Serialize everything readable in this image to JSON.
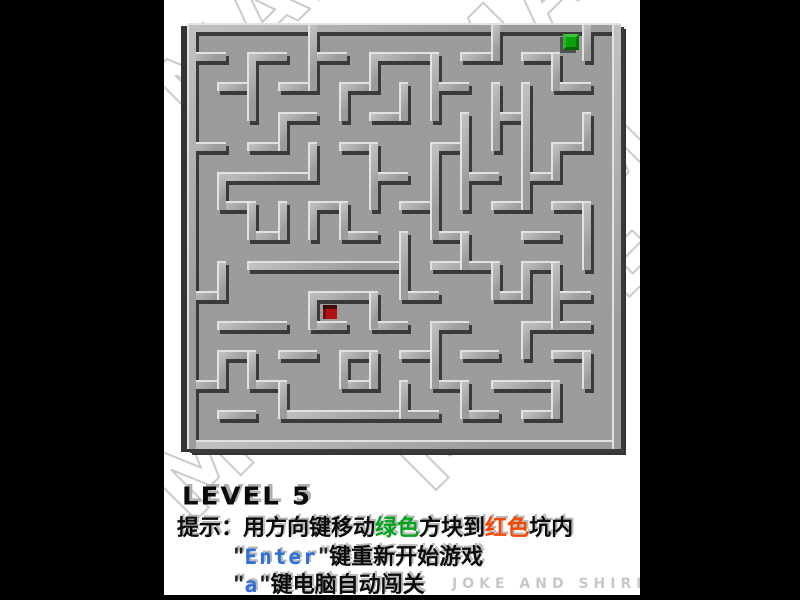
{
  "window": {
    "background": "#000000",
    "canvas_background": "#ffffff",
    "canvas_left": 164,
    "canvas_width": 476,
    "canvas_height": 595
  },
  "watermark": {
    "text": "MAZE",
    "stroke_color": "#cbcbcb",
    "instances": [
      {
        "left": -40,
        "top": -60,
        "size": 90
      },
      {
        "left": 240,
        "top": -80,
        "size": 90
      },
      {
        "left": -50,
        "top": 320,
        "size": 100
      },
      {
        "left": 190,
        "top": 290,
        "size": 100
      },
      {
        "left": 370,
        "top": 30,
        "size": 90
      }
    ]
  },
  "maze": {
    "grid": {
      "cols": 14,
      "rows": 14,
      "cellW": 30.4,
      "cellH": 29.8,
      "originX": 27,
      "originY": 27,
      "thickness": 9,
      "shadowDX": 3,
      "shadowDY": 4
    },
    "colors": {
      "floor": "#9c9c9c",
      "wall_face": "#a6a6a6",
      "wall_light": "#e2e2e2",
      "wall_shadow": "#3a3a3a"
    },
    "h_walls": [
      [
        0,
        0,
        14
      ],
      [
        14,
        0,
        14
      ],
      [
        1,
        0,
        1
      ],
      [
        1,
        2,
        3
      ],
      [
        1,
        4,
        5
      ],
      [
        1,
        6,
        8
      ],
      [
        1,
        9,
        10
      ],
      [
        1,
        11,
        12
      ],
      [
        2,
        1,
        2
      ],
      [
        2,
        3,
        4
      ],
      [
        2,
        5,
        6
      ],
      [
        2,
        8,
        9
      ],
      [
        2,
        12,
        13
      ],
      [
        3,
        3,
        4
      ],
      [
        3,
        6,
        7
      ],
      [
        3,
        10,
        11
      ],
      [
        4,
        0,
        1
      ],
      [
        4,
        2,
        3
      ],
      [
        4,
        5,
        6
      ],
      [
        4,
        8,
        9
      ],
      [
        4,
        12,
        13
      ],
      [
        5,
        1,
        4
      ],
      [
        5,
        6,
        7
      ],
      [
        5,
        9,
        10
      ],
      [
        5,
        11,
        12
      ],
      [
        6,
        1,
        2
      ],
      [
        6,
        4,
        5
      ],
      [
        6,
        7,
        8
      ],
      [
        6,
        10,
        11
      ],
      [
        6,
        12,
        13
      ],
      [
        7,
        2,
        3
      ],
      [
        7,
        5,
        6
      ],
      [
        7,
        8,
        9
      ],
      [
        7,
        11,
        12
      ],
      [
        8,
        2,
        7
      ],
      [
        8,
        8,
        10
      ],
      [
        8,
        11,
        12
      ],
      [
        9,
        0,
        1
      ],
      [
        9,
        4,
        6
      ],
      [
        9,
        7,
        8
      ],
      [
        9,
        10,
        11
      ],
      [
        9,
        12,
        13
      ],
      [
        10,
        1,
        3
      ],
      [
        10,
        4,
        5
      ],
      [
        10,
        6,
        7
      ],
      [
        10,
        8,
        9
      ],
      [
        10,
        11,
        13
      ],
      [
        11,
        1,
        2
      ],
      [
        11,
        3,
        4
      ],
      [
        11,
        5,
        6
      ],
      [
        11,
        7,
        8
      ],
      [
        11,
        9,
        10
      ],
      [
        11,
        12,
        13
      ],
      [
        12,
        0,
        1
      ],
      [
        12,
        2,
        3
      ],
      [
        12,
        5,
        6
      ],
      [
        12,
        8,
        9
      ],
      [
        12,
        10,
        12
      ],
      [
        13,
        1,
        2
      ],
      [
        13,
        3,
        8
      ],
      [
        13,
        9,
        10
      ],
      [
        13,
        11,
        12
      ]
    ],
    "v_walls": [
      [
        0,
        0,
        14
      ],
      [
        14,
        0,
        14
      ],
      [
        1,
        5,
        6
      ],
      [
        1,
        8,
        9
      ],
      [
        1,
        11,
        12
      ],
      [
        2,
        1,
        3
      ],
      [
        2,
        6,
        7
      ],
      [
        2,
        11,
        12
      ],
      [
        3,
        3,
        4
      ],
      [
        3,
        6,
        7
      ],
      [
        3,
        12,
        13
      ],
      [
        4,
        0,
        2
      ],
      [
        4,
        4,
        5
      ],
      [
        4,
        6,
        7
      ],
      [
        4,
        9,
        10
      ],
      [
        5,
        2,
        3
      ],
      [
        5,
        6,
        7
      ],
      [
        5,
        11,
        12
      ],
      [
        6,
        1,
        2
      ],
      [
        6,
        4,
        6
      ],
      [
        6,
        9,
        10
      ],
      [
        6,
        11,
        12
      ],
      [
        7,
        2,
        3
      ],
      [
        7,
        7,
        9
      ],
      [
        7,
        12,
        13
      ],
      [
        8,
        1,
        3
      ],
      [
        8,
        4,
        7
      ],
      [
        8,
        10,
        12
      ],
      [
        9,
        3,
        6
      ],
      [
        9,
        7,
        8
      ],
      [
        9,
        12,
        13
      ],
      [
        10,
        0,
        1
      ],
      [
        10,
        2,
        4
      ],
      [
        10,
        8,
        9
      ],
      [
        11,
        2,
        6
      ],
      [
        11,
        8,
        9
      ],
      [
        11,
        10,
        11
      ],
      [
        12,
        1,
        2
      ],
      [
        12,
        4,
        5
      ],
      [
        12,
        8,
        10
      ],
      [
        12,
        12,
        13
      ],
      [
        13,
        0,
        1
      ],
      [
        13,
        3,
        4
      ],
      [
        13,
        6,
        8
      ],
      [
        13,
        11,
        12
      ]
    ],
    "green_block": {
      "cell": [
        12,
        0
      ],
      "size": 16,
      "color": "#0aa30a"
    },
    "red_pit": {
      "cell": [
        4,
        9
      ],
      "size": 14,
      "color": "#b21212"
    }
  },
  "hud": {
    "level_label": "LEVEL 5",
    "level_pos": {
      "left": 18,
      "top": 482
    },
    "lines": [
      {
        "name": "hint-line",
        "left": 13,
        "top": 510,
        "segments": [
          {
            "text": "提示：用方向键移动",
            "kind": "black"
          },
          {
            "text": "绿色",
            "kind": "green"
          },
          {
            "text": "方块到",
            "kind": "black"
          },
          {
            "text": "红色",
            "kind": "red"
          },
          {
            "text": "坑内",
            "kind": "black"
          }
        ]
      },
      {
        "name": "restart-line",
        "left": 69,
        "top": 539,
        "segments": [
          {
            "text": "\"",
            "kind": "dark"
          },
          {
            "text": "Enter",
            "kind": "blue"
          },
          {
            "text": "\"",
            "kind": "dark"
          },
          {
            "text": "键重新开始游戏",
            "kind": "black"
          }
        ]
      },
      {
        "name": "autoplay-line",
        "left": 69,
        "top": 567,
        "segments": [
          {
            "text": "\"",
            "kind": "dark"
          },
          {
            "text": "a",
            "kind": "blue"
          },
          {
            "text": "\"",
            "kind": "dark"
          },
          {
            "text": "键电脑自动闯关",
            "kind": "black"
          }
        ]
      }
    ],
    "credit": "JOKE AND SHIRLEY",
    "credit_pos": {
      "left": 288,
      "top": 576
    },
    "colors": {
      "green": "#00a41c",
      "red": "#f84800",
      "blue": "#2e6fd8",
      "black": "#0b0b0b",
      "credit": "#c6c9cc"
    }
  }
}
